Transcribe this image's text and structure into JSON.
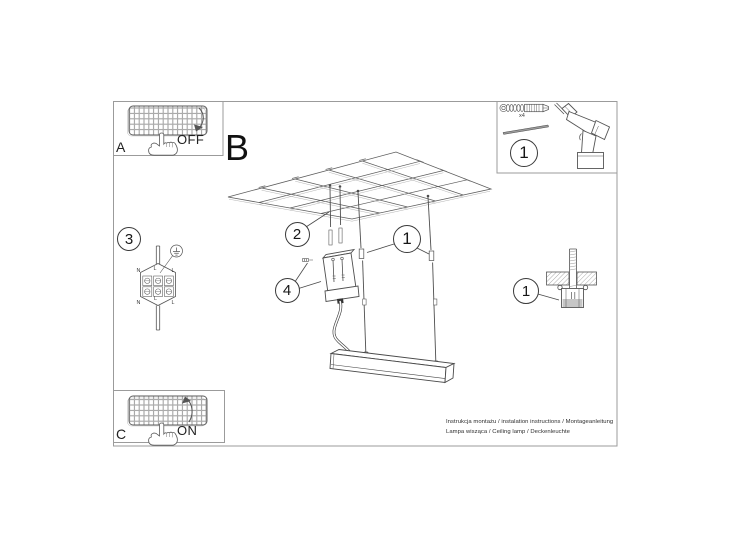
{
  "labels": {
    "step_a": "A",
    "step_b": "B",
    "step_c": "C",
    "off": "OFF",
    "on": "ON",
    "qty": "x4"
  },
  "callouts": {
    "tools": "1",
    "hangers": "2",
    "wire_lock": "1",
    "canopy": "4",
    "wiring": "3",
    "anchor": "1"
  },
  "wiring": {
    "n_top": "N",
    "l_top": "L",
    "l_mid_top": "L",
    "n_bottom": "N",
    "l_bottom": "L",
    "l_mid_bottom": "L"
  },
  "footer": {
    "line1": "Instrukcja montażu / instalation instructions / Montageanleitung",
    "line2": "Lampa wisząca / Ceiling lamp / Deckenleuchte"
  }
}
